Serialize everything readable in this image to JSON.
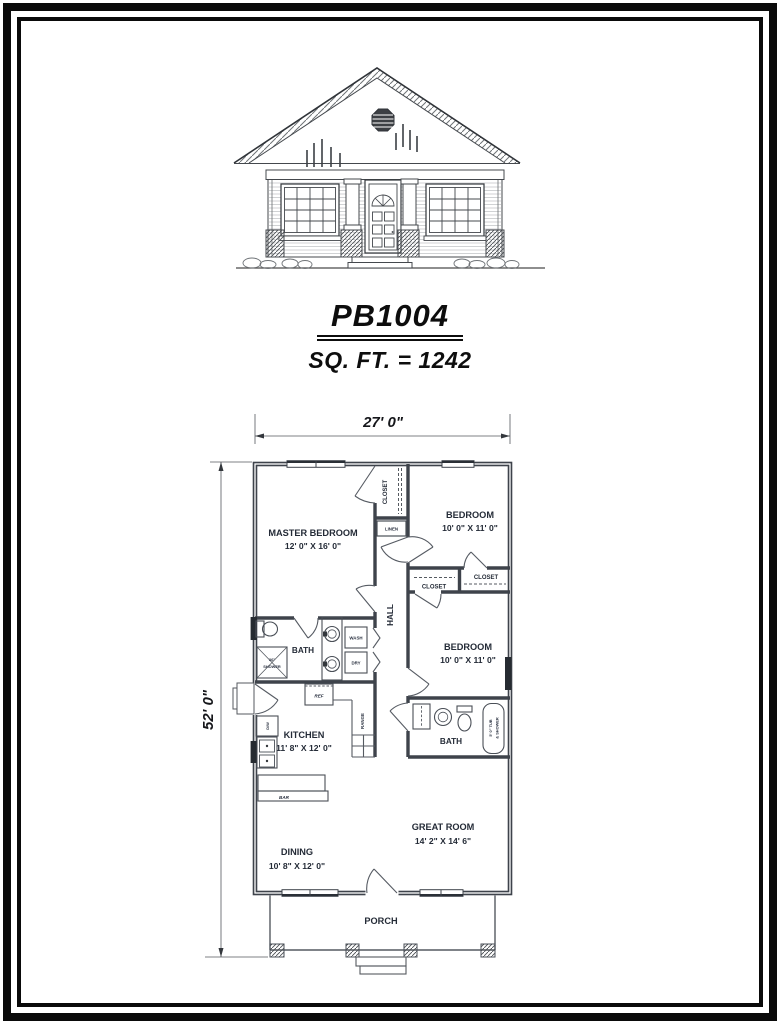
{
  "title_block": {
    "plan_number": "PB1004",
    "square_footage": "SQ. FT. = 1242"
  },
  "dimensions": {
    "overall_width": "27' 0\"",
    "overall_depth": "52' 0\""
  },
  "rooms": {
    "master_bedroom": {
      "name": "MASTER BEDROOM",
      "size": "12' 0\" X 16' 0\""
    },
    "bedroom_top_right": {
      "name": "BEDROOM",
      "size": "10' 0\" X 11' 0\""
    },
    "bedroom_mid_right": {
      "name": "BEDROOM",
      "size": "10' 0\" X 11' 0\""
    },
    "kitchen": {
      "name": "KITCHEN",
      "size": "11' 8\" X 12' 0\""
    },
    "dining": {
      "name": "DINING",
      "size": "10' 8\" X 12' 0\""
    },
    "great_room": {
      "name": "GREAT ROOM",
      "size": "14' 2\" X 14' 6\""
    },
    "hall": {
      "name": "HALL"
    },
    "bath_hall": {
      "name": "BATH"
    },
    "bath_right": {
      "name": "BATH"
    },
    "porch": {
      "name": "PORCH"
    }
  },
  "labels": {
    "closet": "CLOSET",
    "linen": "LINEN",
    "wash": "WASH",
    "dry": "DRY",
    "ref": "REF",
    "range": "RANGE",
    "dishwasher": "D/W",
    "bar": "BAR",
    "shower_size": "36\"",
    "shower": "SHOWER",
    "tub_line1": "5' 0\" TUB",
    "tub_line2": "& SHOWER"
  },
  "colors": {
    "paper": "#ffffff",
    "border": "#0a0a0a",
    "ink": "#111111",
    "plan_line": "#3e434b",
    "plan_text": "#242b37"
  }
}
